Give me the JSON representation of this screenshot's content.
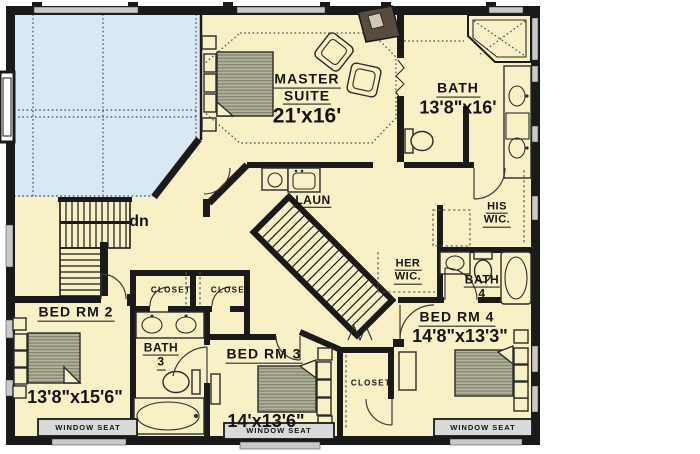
{
  "canvas": {
    "width": 700,
    "height": 454
  },
  "colors": {
    "background": "#ffffff",
    "floor": "#f8f1c6",
    "open_to_below": "#d8e8f5",
    "wall": "#1a1a1a",
    "window": "#c9c9c9",
    "window_seat": "#d9d9d9",
    "furniture_stroke": "#2b2b2b",
    "mattress_light": "#b2b29c",
    "mattress_dark": "#85856f",
    "fireplace": "#584c3e"
  },
  "rooms": {
    "master_suite": {
      "name_line1": "MASTER",
      "name_line2": "SUITE",
      "dim": "21'x16'"
    },
    "master_bath": {
      "name": "BATH",
      "dim": "13'8\"x16'"
    },
    "laundry": {
      "name": "LAUN"
    },
    "his_wic": {
      "name_line1": "HIS",
      "name_line2": "WIC."
    },
    "her_wic": {
      "name_line1": "HER",
      "name_line2": "WIC."
    },
    "bath_4": {
      "name_line1": "BATH",
      "name_line2": "4"
    },
    "bath_3": {
      "name_line1": "BATH",
      "name_line2": "3"
    },
    "bedroom_2": {
      "name": "BED RM 2",
      "dim": "13'8\"x15'6\""
    },
    "bedroom_3": {
      "name": "BED RM 3",
      "dim": "14'x13'6\""
    },
    "bedroom_4": {
      "name": "BED RM 4",
      "dim": "14'8\"x13'3\""
    }
  },
  "annotations": {
    "stair_direction": "dn",
    "closet_1": "CLOSET",
    "closet_2": "CLOSET",
    "closet_3": "CLOSET",
    "window_seat_1": "WINDOW SEAT",
    "window_seat_2": "WINDOW SEAT",
    "window_seat_3": "WINDOW SEAT"
  }
}
